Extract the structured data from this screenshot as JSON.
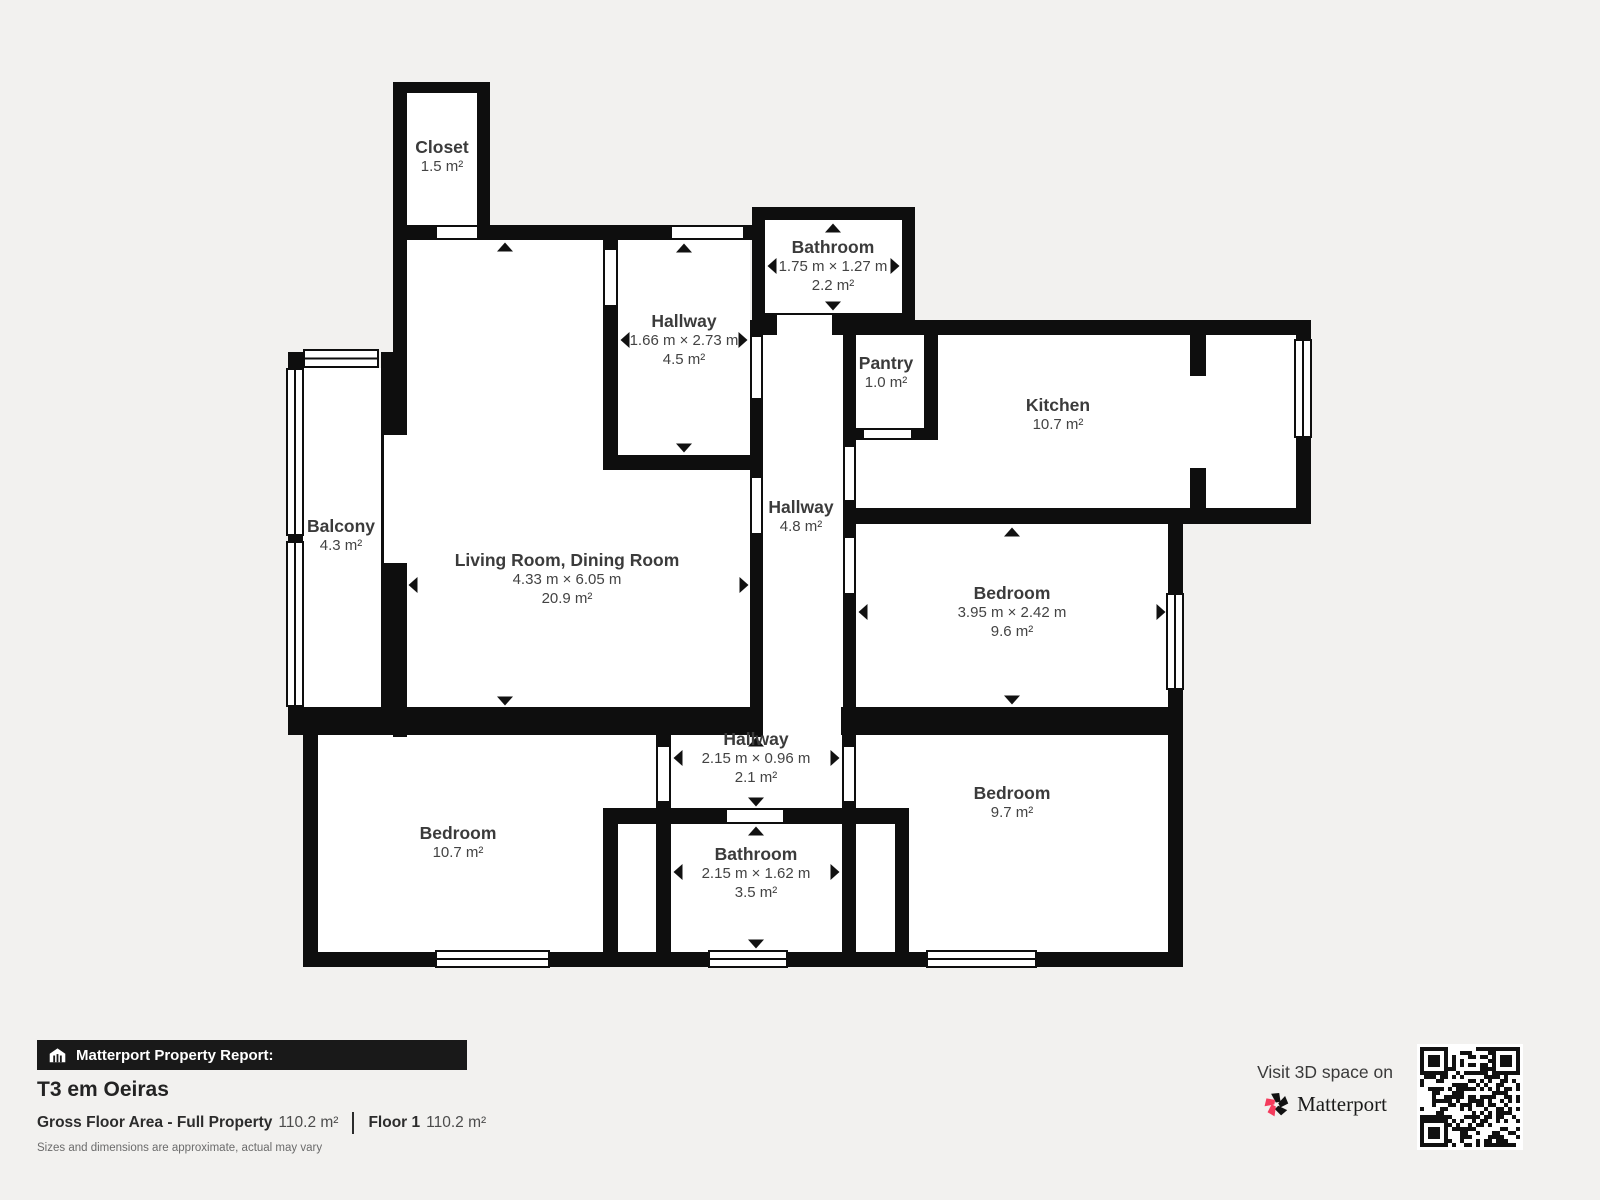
{
  "colors": {
    "wall": "#0e0e0e",
    "background": "#f2f1ef",
    "accent_pink": "#f43b5c"
  },
  "rooms": {
    "closet": {
      "name": "Closet",
      "area": "1.5 m²"
    },
    "hallway_top": {
      "name": "Hallway",
      "dims": "1.66 m × 2.73 m",
      "area": "4.5 m²"
    },
    "bathroom_top": {
      "name": "Bathroom",
      "dims": "1.75 m × 1.27 m",
      "area": "2.2 m²"
    },
    "pantry": {
      "name": "Pantry",
      "area": "1.0 m²"
    },
    "kitchen": {
      "name": "Kitchen",
      "area": "10.7 m²"
    },
    "balcony": {
      "name": "Balcony",
      "area": "4.3 m²"
    },
    "living_dining": {
      "name": "Living Room, Dining Room",
      "dims": "4.33 m × 6.05 m",
      "area": "20.9 m²"
    },
    "hallway_mid": {
      "name": "Hallway",
      "area": "4.8 m²"
    },
    "bedroom_mid_right": {
      "name": "Bedroom",
      "dims": "3.95 m × 2.42 m",
      "area": "9.6 m²"
    },
    "hallway_bottom": {
      "name": "Hallway",
      "dims": "2.15 m × 0.96 m",
      "area": "2.1 m²"
    },
    "bedroom_bottom_left": {
      "name": "Bedroom",
      "area": "10.7 m²"
    },
    "bathroom_bottom": {
      "name": "Bathroom",
      "dims": "2.15 m × 1.62 m",
      "area": "3.5 m²"
    },
    "bedroom_bottom_right": {
      "name": "Bedroom",
      "area": "9.7 m²"
    }
  },
  "footer": {
    "report_bar": "Matterport Property Report:",
    "property_title": "T3 em Oeiras",
    "gross_label": "Gross Floor Area - Full Property",
    "gross_value": "110.2 m²",
    "floor_label": "Floor 1",
    "floor_value": "110.2 m²",
    "disclaimer": "Sizes and dimensions are approximate, actual may vary",
    "visit_text": "Visit 3D space on",
    "brand": "Matterport"
  }
}
